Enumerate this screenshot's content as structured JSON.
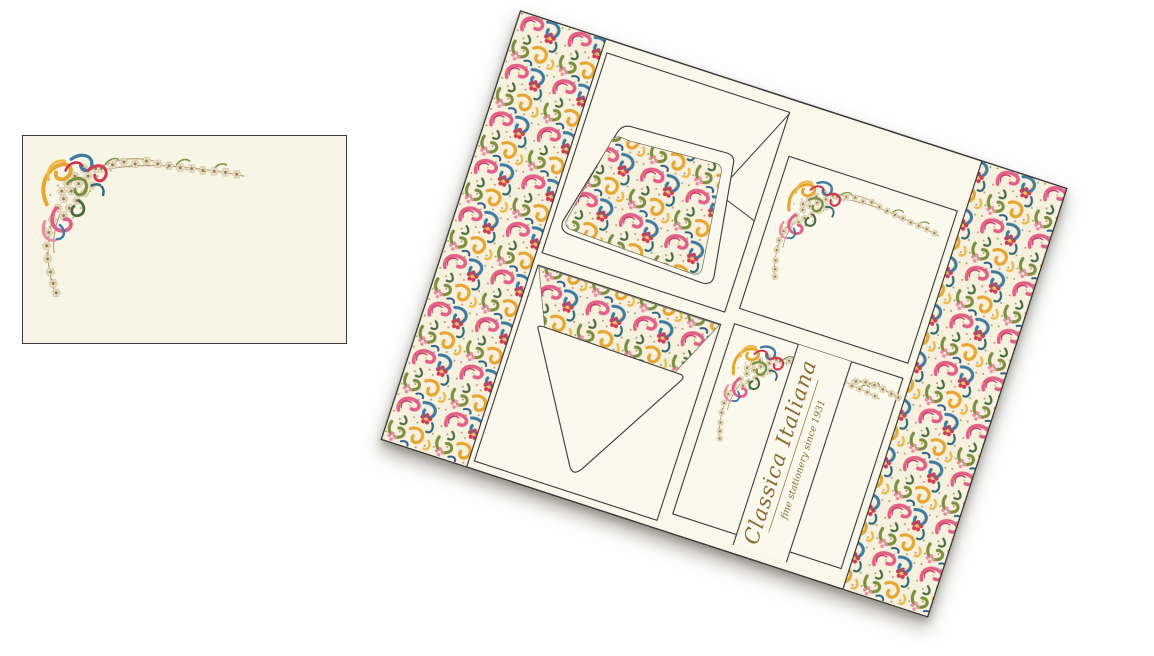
{
  "product": {
    "brand_script": "Classica Italiana",
    "tagline": "fine stationery since 1931"
  },
  "palette": {
    "page_background": "#ffffff",
    "box_interior_cream": "#f9f6ea",
    "card_cream": "#fbf8ed",
    "flat_card_cream": "#f8f5e6",
    "outline_gray": "#3a3a3a",
    "brand_gold": "#8a6c34",
    "floral_pink": "#e45f88",
    "floral_light_pink": "#ef8aa4",
    "floral_red": "#d23a52",
    "floral_gold": "#e8a52f",
    "floral_olive": "#7d8f3e",
    "floral_dark_green": "#486b3f",
    "floral_blue": "#3e7ba4",
    "floral_teal": "#2e6b77",
    "floral_tan": "#b49a6e"
  }
}
